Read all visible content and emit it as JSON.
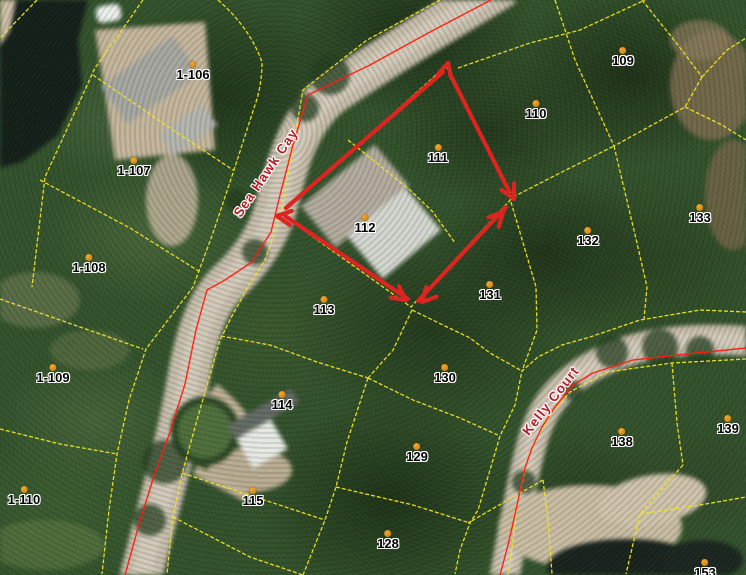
{
  "map": {
    "road_labels": [
      {
        "text": "Sea Hawk Cay",
        "x": 266,
        "y": 173,
        "rotation_deg": -56
      },
      {
        "text": "Kelly Court",
        "x": 551,
        "y": 401,
        "rotation_deg": -52
      }
    ],
    "parcel_markers": [
      {
        "label": "1-106",
        "x": 193,
        "y": 74
      },
      {
        "label": "1-107",
        "x": 134,
        "y": 170
      },
      {
        "label": "1-108",
        "x": 89,
        "y": 267
      },
      {
        "label": "1-109",
        "x": 53,
        "y": 377
      },
      {
        "label": "1-110",
        "x": 24,
        "y": 499
      },
      {
        "label": "109",
        "x": 623,
        "y": 60
      },
      {
        "label": "110",
        "x": 536,
        "y": 113
      },
      {
        "label": "111",
        "x": 438,
        "y": 157
      },
      {
        "label": "112",
        "x": 365,
        "y": 227
      },
      {
        "label": "113",
        "x": 324,
        "y": 309
      },
      {
        "label": "114",
        "x": 282,
        "y": 404
      },
      {
        "label": "115",
        "x": 253,
        "y": 500
      },
      {
        "label": "128",
        "x": 388,
        "y": 543
      },
      {
        "label": "129",
        "x": 417,
        "y": 456
      },
      {
        "label": "130",
        "x": 445,
        "y": 377
      },
      {
        "label": "131",
        "x": 490,
        "y": 294
      },
      {
        "label": "132",
        "x": 588,
        "y": 240
      },
      {
        "label": "133",
        "x": 700,
        "y": 217
      },
      {
        "label": "138",
        "x": 622,
        "y": 441
      },
      {
        "label": "139",
        "x": 728,
        "y": 428
      },
      {
        "label": "153",
        "x": 705,
        "y": 572
      }
    ],
    "annotation": {
      "color": "#dc2420",
      "stroke_width": 4.2,
      "segments": [
        {
          "x1": 286,
          "y1": 208,
          "x2": 443,
          "y2": 72
        },
        {
          "x1": 450,
          "y1": 74,
          "x2": 509,
          "y2": 191
        },
        {
          "x1": 506,
          "y1": 207,
          "x2": 418,
          "y2": 301
        },
        {
          "x1": 408,
          "y1": 299,
          "x2": 285,
          "y2": 216
        }
      ],
      "arrowheads": [
        {
          "x": 448,
          "y": 63,
          "angle_deg": -75
        },
        {
          "x": 514,
          "y": 199,
          "angle_deg": 63
        },
        {
          "x": 503,
          "y": 212,
          "angle_deg": -47
        },
        {
          "x": 422,
          "y": 302,
          "angle_deg": 133
        },
        {
          "x": 406,
          "y": 300,
          "angle_deg": 36
        },
        {
          "x": 277,
          "y": 216,
          "angle_deg": 188
        }
      ]
    },
    "colors": {
      "parcel_line": "#f2e424",
      "road_centerline": "#ff1c0e",
      "annotation_arrow": "#dc2420",
      "marker_dot": "#e0891a",
      "parcel_label_text": "#000000",
      "parcel_label_halo": "#ffffff",
      "road_label_text": "#b3202a"
    }
  }
}
